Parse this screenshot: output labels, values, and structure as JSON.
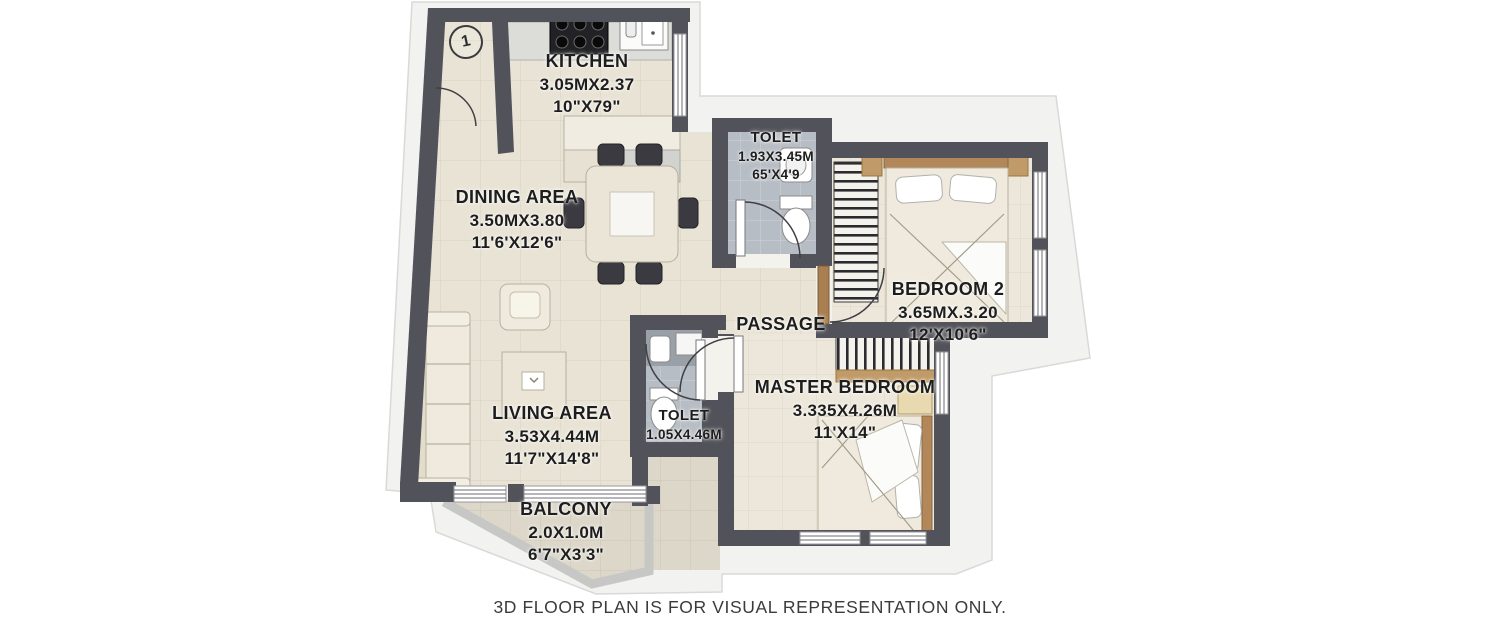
{
  "caption": "3D FLOOR PLAN IS FOR VISUAL REPRESENTATION ONLY.",
  "unit_marker": "1",
  "rooms": {
    "kitchen": {
      "name": "KITCHEN",
      "dim_m": "3.05MX2.37",
      "dim_ft": "10\"X79\""
    },
    "dining": {
      "name": "DINING AREA",
      "dim_m": "3.50MX3.80",
      "dim_ft": "11'6'X12'6\""
    },
    "toilet_top": {
      "name": "TOLET",
      "dim_m": "1.93X3.45M",
      "dim_ft": "65'X4'9"
    },
    "bedroom2": {
      "name": "BEDROOM 2",
      "dim_m": "3.65MX.3.20",
      "dim_ft": "12'X10'6\""
    },
    "passage": {
      "name": "PASSAGE"
    },
    "master_bedroom": {
      "name": "MASTER BEDROOM",
      "dim_m": "3.335X4.26M",
      "dim_ft": "11'X14\""
    },
    "living": {
      "name": "LIVING AREA",
      "dim_m": "3.53X4.44M",
      "dim_ft": "11'7\"X14'8\""
    },
    "toilet_bottom": {
      "name": "TOLET",
      "dim_m": "1.05X4.46M"
    },
    "balcony": {
      "name": "BALCONY",
      "dim_m": "2.0X1.0M",
      "dim_ft": "6'7\"X3'3\""
    }
  },
  "colors": {
    "wall": "#52525a",
    "plinth": "#f2f2f1",
    "floor_beige": "#e8e3d5",
    "floor_bedroom": "#ece7da",
    "floor_tile_gray": "#b7bdc4",
    "floor_balcony": "#dcd7c9",
    "wood_accent": "#b2885a",
    "door_wood": "#a87f50"
  }
}
